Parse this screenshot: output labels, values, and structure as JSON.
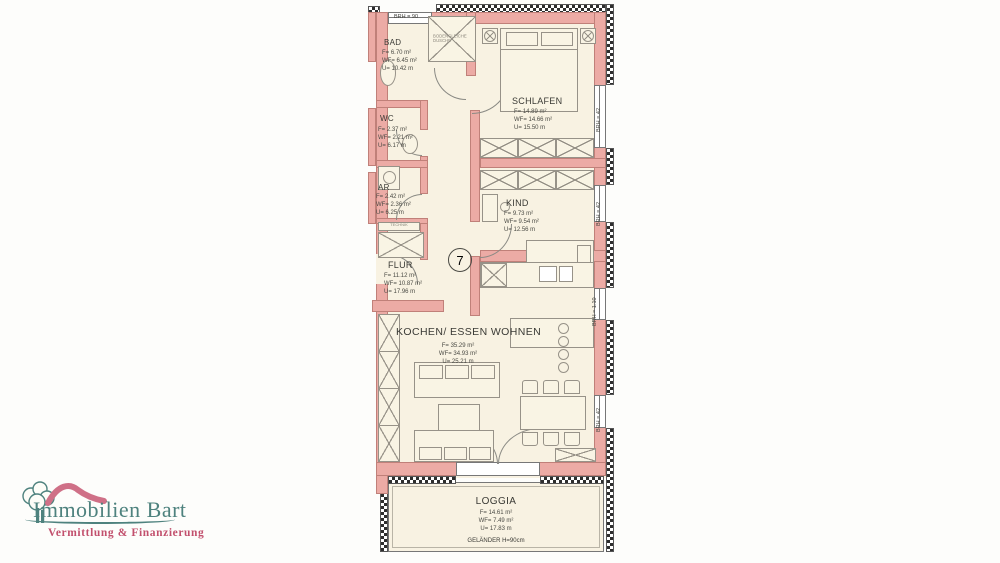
{
  "logo": {
    "company": "Immobilien Bart",
    "tagline": "Vermittlung & Finanzierung",
    "colors": {
      "teal": "#4e827e",
      "rose_text": "#c2506d",
      "rose_roof": "#cf7087"
    }
  },
  "plan": {
    "unit_number": "7",
    "rooms": {
      "bad": {
        "name": "BAD",
        "f": "F= 6.70 m²",
        "wf": "WF= 6.45 m²",
        "u": "U= 10.42 m"
      },
      "schlafen": {
        "name": "SCHLAFEN",
        "f": "F= 14.89 m²",
        "wf": "WF= 14.66 m²",
        "u": "U= 15.50 m"
      },
      "wc": {
        "name": "WC",
        "f": "F= 2.37 m²",
        "wf": "WF= 2.21 m²",
        "u": "U= 6.17 m"
      },
      "ar": {
        "name": "AR",
        "f": "F= 2.42 m²",
        "wf": "WF= 2.36 m²",
        "u": "U= 6.25 m"
      },
      "kind": {
        "name": "KIND",
        "f": "F= 9.73 m²",
        "wf": "WF= 9.54 m²",
        "u": "U= 12.56 m"
      },
      "flur": {
        "name": "FLUR",
        "f": "F= 11.12 m²",
        "wf": "WF= 10.87 m²",
        "u": "U= 17.96 m"
      },
      "wohnen": {
        "name": "KOCHEN/ ESSEN WOHNEN",
        "f": "F= 35.29 m²",
        "wf": "WF= 34.93 m²",
        "u": "U= 25.21 m"
      },
      "loggia": {
        "name": "LOGGIA",
        "f": "F= 14.61 m²",
        "wf": "WF= 7.49 m²",
        "u": "U= 17.83 m"
      }
    },
    "annotations": {
      "brh_90": "BRH = 90",
      "brh_42": "BRH = 42",
      "brh_110": "BRH = 1.10",
      "technik": "TECHNIK",
      "shower": "BODENGLEICHE DUSCHE",
      "railing": "GELÄNDER H=90cm"
    },
    "colors": {
      "wall": "#ecaba5",
      "floor": "#f8f2e2",
      "line": "#979288"
    }
  }
}
